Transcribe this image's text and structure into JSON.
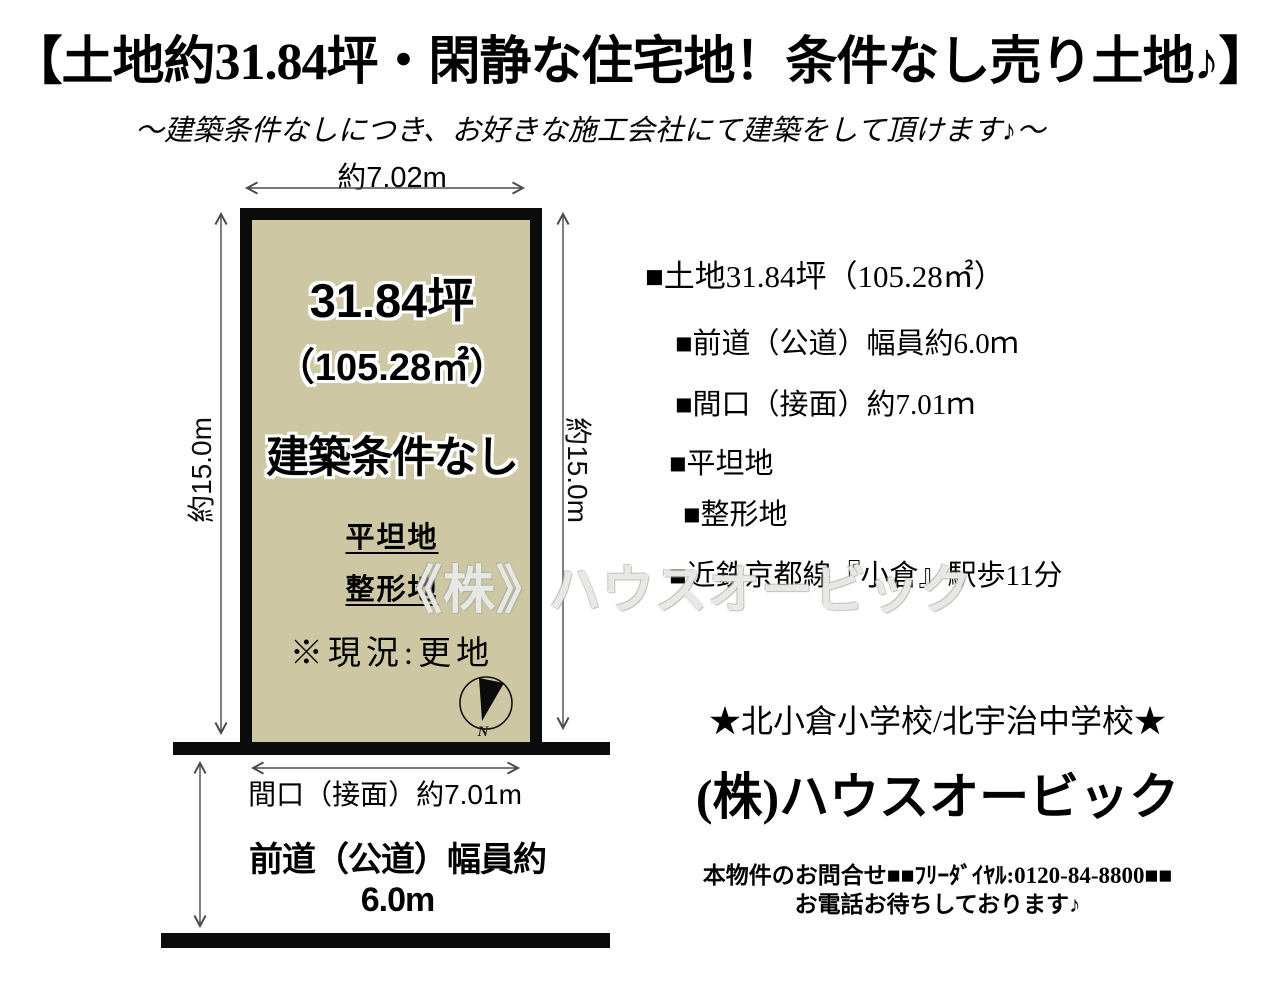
{
  "title": "【土地約31.84坪・閑静な住宅地！条件なし売り土地♪】",
  "subtitle": "～建築条件なしにつき、お好きな施工会社にて建築をして頂けます♪～",
  "diagram": {
    "top_dimension": "約7.02m",
    "left_dimension": "約15.0m",
    "right_dimension": "約15.0m",
    "plot": {
      "area_tsubo": "31.84坪",
      "area_m2": "（105.28㎡）",
      "condition": "建築条件なし",
      "feature_flat": "平坦地",
      "feature_shaped": "整形地",
      "status_note": "※現況:更地",
      "fill_color": "#cdc8a3",
      "border_color": "#0b0b0b"
    },
    "compass_label": "N",
    "frontage_label": "間口（接面）約7.01m",
    "road_width_label": "前道（公道）幅員約6.0m"
  },
  "details": {
    "items": [
      "■土地31.84坪（105.28㎡）",
      "■前道（公道）幅員約6.0ｍ",
      "■間口（接面）約7.01ｍ",
      "■平坦地",
      "■整形地",
      "■近鉄京都線『小倉』駅歩11分"
    ]
  },
  "footer": {
    "schools": "★北小倉小学校/北宇治中学校★",
    "company": "(株)ハウスオービック",
    "contact_line1": "本物件のお問合せ■■ﾌﾘｰﾀﾞｲﾔﾙ:0120-84-8800■■",
    "contact_line2": "お電話お待ちしております♪"
  },
  "watermark": "《株》ハウスオービック",
  "colors": {
    "background": "#ffffff",
    "text": "#000000",
    "arrow": "#4b4b4b"
  }
}
